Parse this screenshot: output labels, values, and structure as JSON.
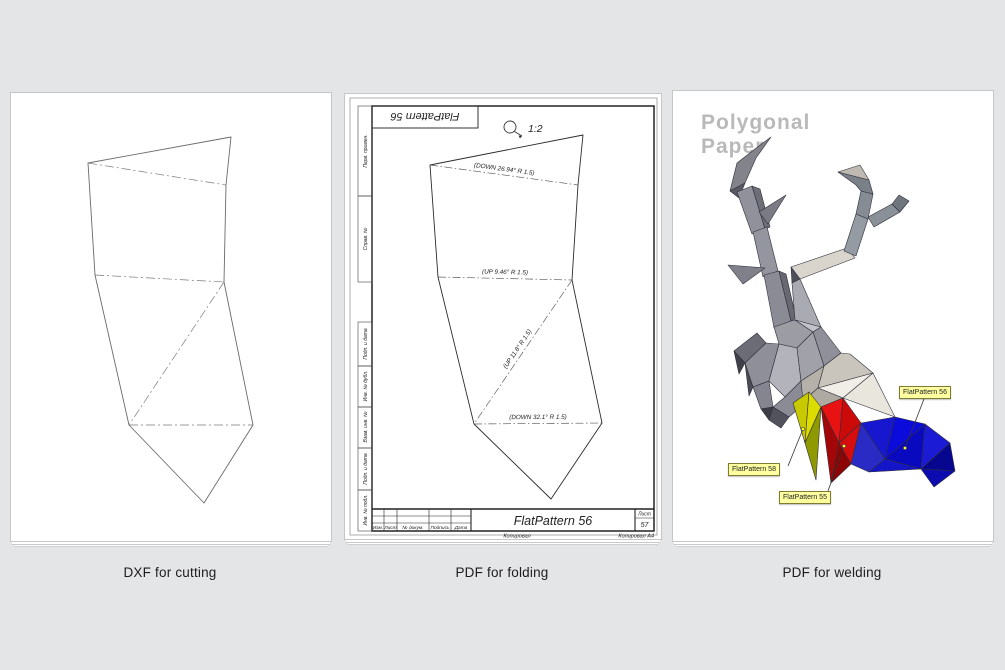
{
  "page_bg": "#e4e5e6",
  "panels": {
    "cutting": {
      "caption": "DXF for cutting"
    },
    "folding": {
      "caption": "PDF for folding",
      "stamp": "FlatPattern 56",
      "scale": "1:2",
      "folds": {
        "top": "(DOWN 26.94° R 1.5)",
        "middle": "(UP 9.46° R 1.5)",
        "diagonal": "(UP 11.8° R 1.5)",
        "bottom": "(DOWN 32.1° R 1.5)"
      },
      "side_columns": [
        "Перв. примен.",
        "Справ. №",
        "Подп. и дата",
        "Инв. № дубл.",
        "Взам. инв. №",
        "Подп. и дата",
        "Инв. № подл."
      ],
      "title_block": {
        "title": "FlatPattern 56",
        "columns": [
          "Изм.",
          "Лист",
          "№ докум.",
          "Подпись",
          "Дата"
        ],
        "sheet_label": "Лист",
        "sheet_number": "57",
        "footer_center": "Копировал",
        "footer_right": "Копировал А4"
      }
    },
    "welding": {
      "caption": "PDF for welding",
      "logo": {
        "line1": "Polygonal",
        "line2": "Paper"
      },
      "callouts": [
        {
          "label": "FlatPattern 58",
          "color": "#c8c800"
        },
        {
          "label": "FlatPattern 55",
          "color": "#e01010"
        },
        {
          "label": "FlatPattern 56",
          "color": "#1010d0"
        }
      ],
      "colors": {
        "yellow": "#c8c800",
        "red": "#e01010",
        "blue": "#1010d0",
        "callout_bg": "#ffffa0",
        "callout_border": "#7c7c35",
        "logo_gray": "#b9b9b9"
      }
    }
  }
}
